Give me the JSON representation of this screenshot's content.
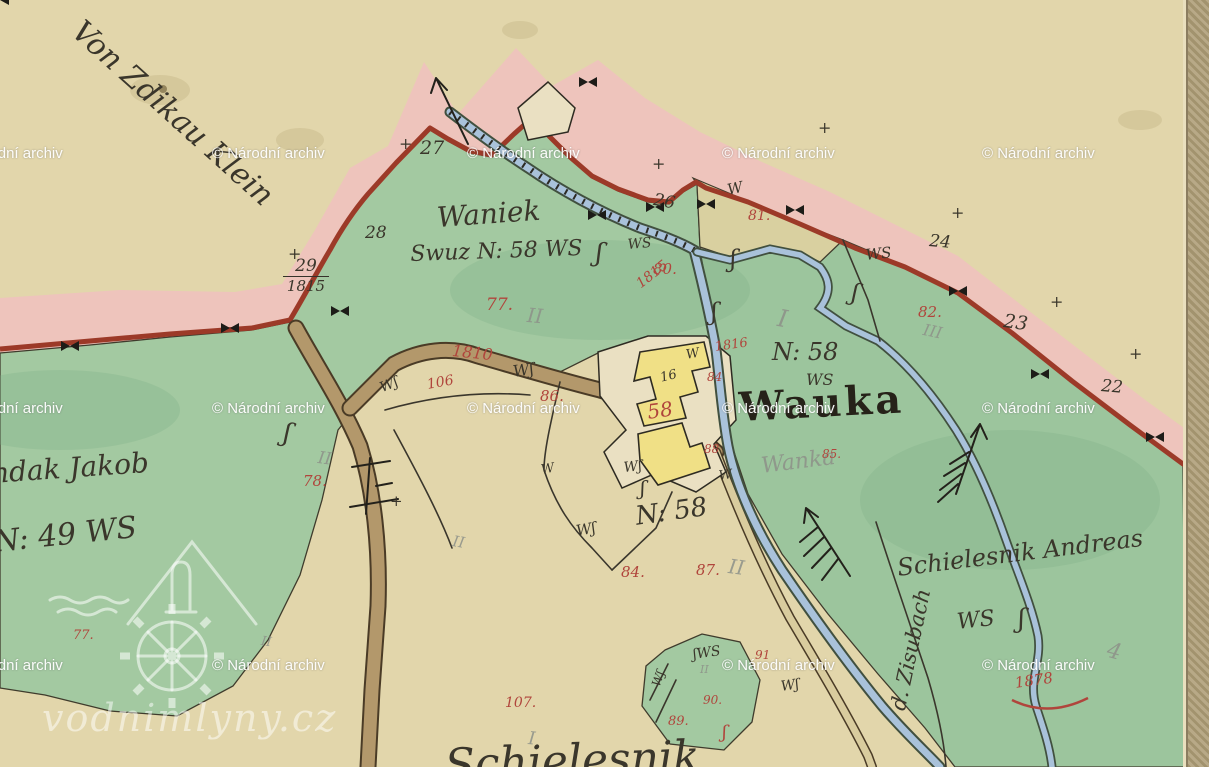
{
  "colors": {
    "paper": "#e2d6ab",
    "green": "#a3c9a1",
    "green2": "#9cc59d",
    "khaki": "#d9d0a0",
    "pink": "#eec4bc",
    "redline": "#9c3a28",
    "road": "#b3986b",
    "pathfill": "#d9cc9e",
    "stream": "#a9c2da",
    "yellow": "#f0e086",
    "plot": "#eae0c2",
    "redInk": "#b0453c"
  },
  "fraction": {
    "top": "29",
    "bottom": "1815"
  },
  "logo": {
    "text": "vodnimlyny.cz"
  },
  "watermarks": {
    "text": "© Národní archiv",
    "positions": [
      [
        -50,
        146
      ],
      [
        212,
        146
      ],
      [
        467,
        146
      ],
      [
        722,
        146
      ],
      [
        982,
        146
      ],
      [
        -50,
        401
      ],
      [
        212,
        401
      ],
      [
        467,
        401
      ],
      [
        722,
        401
      ],
      [
        982,
        401
      ],
      [
        -50,
        658
      ],
      [
        212,
        658
      ],
      [
        722,
        658
      ],
      [
        982,
        658
      ]
    ]
  },
  "annotations": [
    {
      "id": "von-zdikau-klein",
      "text": "Von Zdikau Klein",
      "cls": "ink",
      "x": 86,
      "y": 16,
      "s": 30,
      "r": 42
    },
    {
      "id": "waniek",
      "text": "Waniek",
      "cls": "ink",
      "x": 436,
      "y": 204,
      "s": 28,
      "r": -4
    },
    {
      "id": "waniek-detail",
      "text": "Swuz N: 58 WS",
      "cls": "ink",
      "x": 410,
      "y": 244,
      "s": 22,
      "r": -2
    },
    {
      "id": "n58-upper",
      "text": "N: 58",
      "cls": "ink",
      "x": 772,
      "y": 340,
      "s": 24,
      "r": 0
    },
    {
      "id": "ws-upper",
      "text": "WS",
      "cls": "ink",
      "x": 806,
      "y": 372,
      "s": 16,
      "r": 0
    },
    {
      "id": "wauka",
      "text": "Wauka",
      "cls": "wauka",
      "x": 738,
      "y": 388,
      "s": 40,
      "r": -3
    },
    {
      "id": "wanka-pencil",
      "text": "Wanka",
      "cls": "pencil",
      "x": 760,
      "y": 456,
      "s": 22,
      "r": -7
    },
    {
      "id": "n58-lower",
      "text": "N: 58",
      "cls": "ink",
      "x": 634,
      "y": 504,
      "s": 26,
      "r": -8
    },
    {
      "id": "schielesnik",
      "text": "Schielesnik Andreas",
      "cls": "ink",
      "x": 896,
      "y": 556,
      "s": 24,
      "r": -7
    },
    {
      "id": "ws-schielesnik",
      "text": "WS",
      "cls": "ink",
      "x": 956,
      "y": 612,
      "s": 22,
      "r": -6
    },
    {
      "id": "ndak-jakob",
      "text": "ndak Jakob",
      "cls": "ink",
      "x": -10,
      "y": 460,
      "s": 28,
      "r": -4
    },
    {
      "id": "n49",
      "text": "N: 49 WS",
      "cls": "ink",
      "x": -8,
      "y": 528,
      "s": 30,
      "r": -6
    },
    {
      "id": "zisubach",
      "text": "d. Zisubach",
      "cls": "ink",
      "x": 888,
      "y": 708,
      "s": 21,
      "r": -78
    },
    {
      "id": "bottom-script",
      "text": "Schielesnik",
      "cls": "ink",
      "x": 444,
      "y": 744,
      "s": 44,
      "r": -2
    },
    {
      "id": "b27",
      "text": "27",
      "cls": "ink",
      "x": 420,
      "y": 139,
      "s": 19,
      "r": 0
    },
    {
      "id": "b28",
      "text": "28",
      "cls": "ink",
      "x": 365,
      "y": 225,
      "s": 17,
      "r": 0
    },
    {
      "id": "b26",
      "text": "26",
      "cls": "ink",
      "x": 655,
      "y": 192,
      "s": 17,
      "r": 10
    },
    {
      "id": "b24",
      "text": "24",
      "cls": "ink",
      "x": 930,
      "y": 233,
      "s": 17,
      "r": 5
    },
    {
      "id": "b23",
      "text": "23",
      "cls": "ink",
      "x": 1005,
      "y": 312,
      "s": 19,
      "r": 8
    },
    {
      "id": "b22",
      "text": "22",
      "cls": "ink",
      "x": 1102,
      "y": 378,
      "s": 17,
      "r": 5
    },
    {
      "id": "b2-edge",
      "text": "2",
      "cls": "ink",
      "x": 1196,
      "y": 404,
      "s": 15,
      "r": 0
    },
    {
      "id": "bldg-16",
      "text": "16",
      "cls": "ink",
      "x": 659,
      "y": 372,
      "s": 13,
      "r": -14
    },
    {
      "id": "bldg-58",
      "text": "58",
      "cls": "red",
      "x": 646,
      "y": 402,
      "s": 20,
      "r": -8
    },
    {
      "id": "w-khaki",
      "text": "W",
      "cls": "ink",
      "x": 726,
      "y": 183,
      "s": 15,
      "r": -12
    },
    {
      "id": "ws-1",
      "text": "WS",
      "cls": "ink",
      "x": 627,
      "y": 238,
      "s": 14,
      "r": -5
    },
    {
      "id": "ws-2",
      "text": "WS",
      "cls": "ink",
      "x": 865,
      "y": 248,
      "s": 15,
      "r": -6
    },
    {
      "id": "w-road",
      "text": "Wʃ",
      "cls": "ink",
      "x": 512,
      "y": 364,
      "s": 16,
      "r": -8
    },
    {
      "id": "w-vroad",
      "text": "Wʃ",
      "cls": "ink",
      "x": 378,
      "y": 382,
      "s": 14,
      "r": -22
    },
    {
      "id": "w-mid1",
      "text": "W",
      "cls": "ink",
      "x": 685,
      "y": 349,
      "s": 13,
      "r": -10
    },
    {
      "id": "w-mid2",
      "text": "Wʃ",
      "cls": "ink",
      "x": 623,
      "y": 461,
      "s": 14,
      "r": -6
    },
    {
      "id": "w-mid3",
      "text": "Wʃ",
      "cls": "ink",
      "x": 575,
      "y": 524,
      "s": 15,
      "r": -10
    },
    {
      "id": "w-mid4",
      "text": "W",
      "cls": "ink",
      "x": 718,
      "y": 470,
      "s": 13,
      "r": -8
    },
    {
      "id": "w-mid5",
      "text": "W",
      "cls": "ink",
      "x": 540,
      "y": 464,
      "s": 13,
      "r": -10
    },
    {
      "id": "sws-patch",
      "text": "ʃWS",
      "cls": "ink",
      "x": 692,
      "y": 648,
      "s": 14,
      "r": -8
    },
    {
      "id": "w-patch",
      "text": "Wʃ",
      "cls": "ink",
      "x": 650,
      "y": 684,
      "s": 12,
      "r": -70
    },
    {
      "id": "w-path",
      "text": "Wʃ",
      "cls": "ink",
      "x": 780,
      "y": 680,
      "s": 14,
      "r": -8
    },
    {
      "id": "sw-1",
      "text": "ʃ",
      "cls": "ink",
      "x": 286,
      "y": 420,
      "s": 26,
      "r": 10
    },
    {
      "id": "sw-2",
      "text": "ʃ",
      "cls": "ink",
      "x": 597,
      "y": 240,
      "s": 26,
      "r": 5
    },
    {
      "id": "sw-3",
      "text": "ʃ",
      "cls": "ink",
      "x": 730,
      "y": 247,
      "s": 24,
      "r": 0
    },
    {
      "id": "sw-4",
      "text": "ʃ",
      "cls": "ink",
      "x": 854,
      "y": 280,
      "s": 24,
      "r": 10
    },
    {
      "id": "sw-5",
      "text": "ʃ",
      "cls": "ink",
      "x": 711,
      "y": 300,
      "s": 24,
      "r": 0
    },
    {
      "id": "sw-6",
      "text": "ʃ",
      "cls": "ink",
      "x": 1018,
      "y": 606,
      "s": 26,
      "r": 0
    },
    {
      "id": "sw-7",
      "text": "ʃ",
      "cls": "ink",
      "x": 640,
      "y": 478,
      "s": 20,
      "r": 0
    },
    {
      "id": "sw-red",
      "text": "ʃ",
      "cls": "red",
      "x": 722,
      "y": 724,
      "s": 18,
      "r": 0
    },
    {
      "id": "p77",
      "text": "77.",
      "cls": "red",
      "x": 486,
      "y": 297,
      "s": 17,
      "r": 0
    },
    {
      "id": "p80",
      "text": "80.",
      "cls": "red",
      "x": 653,
      "y": 262,
      "s": 15,
      "r": 0
    },
    {
      "id": "p81",
      "text": "81.",
      "cls": "red",
      "x": 748,
      "y": 209,
      "s": 14,
      "r": 0
    },
    {
      "id": "p82",
      "text": "82.",
      "cls": "red",
      "x": 918,
      "y": 305,
      "s": 15,
      "r": 0
    },
    {
      "id": "y1815",
      "text": "1815",
      "cls": "red",
      "x": 634,
      "y": 280,
      "s": 14,
      "r": -38
    },
    {
      "id": "y1816",
      "text": "1816",
      "cls": "red",
      "x": 714,
      "y": 341,
      "s": 13,
      "r": -8
    },
    {
      "id": "y1810",
      "text": "1810",
      "cls": "red",
      "x": 453,
      "y": 343,
      "s": 16,
      "r": 6
    },
    {
      "id": "y1878",
      "text": "1878",
      "cls": "red",
      "x": 1014,
      "y": 676,
      "s": 15,
      "r": -8
    },
    {
      "id": "p84a",
      "text": "84",
      "cls": "red",
      "x": 707,
      "y": 371,
      "s": 12,
      "r": 0
    },
    {
      "id": "p88",
      "text": "88",
      "cls": "red",
      "x": 704,
      "y": 443,
      "s": 12,
      "r": 0
    },
    {
      "id": "p85",
      "text": "85.",
      "cls": "red",
      "x": 822,
      "y": 448,
      "s": 12,
      "r": 0
    },
    {
      "id": "p86",
      "text": "86.",
      "cls": "red",
      "x": 540,
      "y": 389,
      "s": 15,
      "r": 0
    },
    {
      "id": "p106",
      "text": "106",
      "cls": "red",
      "x": 426,
      "y": 378,
      "s": 14,
      "r": -10
    },
    {
      "id": "p78",
      "text": "78.",
      "cls": "red",
      "x": 303,
      "y": 474,
      "s": 15,
      "r": 0
    },
    {
      "id": "p84b",
      "text": "84.",
      "cls": "red",
      "x": 621,
      "y": 565,
      "s": 15,
      "r": 0
    },
    {
      "id": "p87",
      "text": "87.",
      "cls": "red",
      "x": 696,
      "y": 563,
      "s": 15,
      "r": 0
    },
    {
      "id": "p107",
      "text": "107.",
      "cls": "red",
      "x": 505,
      "y": 696,
      "s": 14,
      "r": 0
    },
    {
      "id": "p89",
      "text": "89.",
      "cls": "red",
      "x": 668,
      "y": 715,
      "s": 13,
      "r": 0
    },
    {
      "id": "p90",
      "text": "90.",
      "cls": "red",
      "x": 703,
      "y": 694,
      "s": 12,
      "r": 0
    },
    {
      "id": "p91",
      "text": "91",
      "cls": "red",
      "x": 755,
      "y": 649,
      "s": 12,
      "r": 0
    },
    {
      "id": "p77b",
      "text": "77.",
      "cls": "red",
      "x": 73,
      "y": 629,
      "s": 13,
      "r": 0
    },
    {
      "id": "pen-ii-1",
      "text": "II",
      "cls": "pencil",
      "x": 528,
      "y": 305,
      "s": 20,
      "r": 5
    },
    {
      "id": "pen-i-1",
      "text": "I",
      "cls": "pencil",
      "x": 780,
      "y": 306,
      "s": 24,
      "r": 10
    },
    {
      "id": "pen-iii",
      "text": "III",
      "cls": "pencil",
      "x": 925,
      "y": 322,
      "s": 16,
      "r": 12
    },
    {
      "id": "pen-ii-2",
      "text": "II",
      "cls": "pencil",
      "x": 319,
      "y": 450,
      "s": 17,
      "r": 8
    },
    {
      "id": "pen-ii-3",
      "text": "II",
      "cls": "pencil",
      "x": 454,
      "y": 534,
      "s": 15,
      "r": 10
    },
    {
      "id": "pen-ii-4",
      "text": "II",
      "cls": "pencil",
      "x": 730,
      "y": 556,
      "s": 20,
      "r": 8
    },
    {
      "id": "pen-i-2",
      "text": "I",
      "cls": "pencil",
      "x": 529,
      "y": 730,
      "s": 18,
      "r": 5
    },
    {
      "id": "pen-4",
      "text": "4",
      "cls": "pencil",
      "x": 1110,
      "y": 640,
      "s": 22,
      "r": 15
    },
    {
      "id": "pen-ii-5",
      "text": "II",
      "cls": "pencil",
      "x": 262,
      "y": 635,
      "s": 13,
      "r": 8
    },
    {
      "id": "pen-ii-6",
      "text": "II",
      "cls": "pencil",
      "x": 700,
      "y": 664,
      "s": 11,
      "r": 0
    },
    {
      "id": "cross-1",
      "text": "+",
      "cls": "ink",
      "x": 288,
      "y": 246,
      "s": 16,
      "r": 0
    },
    {
      "id": "cross-2",
      "text": "+",
      "cls": "ink",
      "x": 399,
      "y": 136,
      "s": 16,
      "r": 0
    },
    {
      "id": "cross-3",
      "text": "+",
      "cls": "ink",
      "x": 652,
      "y": 156,
      "s": 16,
      "r": 0
    },
    {
      "id": "cross-4",
      "text": "+",
      "cls": "ink",
      "x": 818,
      "y": 120,
      "s": 16,
      "r": 0
    },
    {
      "id": "cross-5",
      "text": "+",
      "cls": "ink",
      "x": 951,
      "y": 205,
      "s": 16,
      "r": 0
    },
    {
      "id": "cross-6",
      "text": "+",
      "cls": "ink",
      "x": 1050,
      "y": 294,
      "s": 16,
      "r": 0
    },
    {
      "id": "cross-7",
      "text": "+",
      "cls": "ink",
      "x": 1129,
      "y": 346,
      "s": 16,
      "r": 0
    },
    {
      "id": "cross-8",
      "text": "+",
      "cls": "ink",
      "x": 390,
      "y": 494,
      "s": 15,
      "r": 0
    }
  ]
}
